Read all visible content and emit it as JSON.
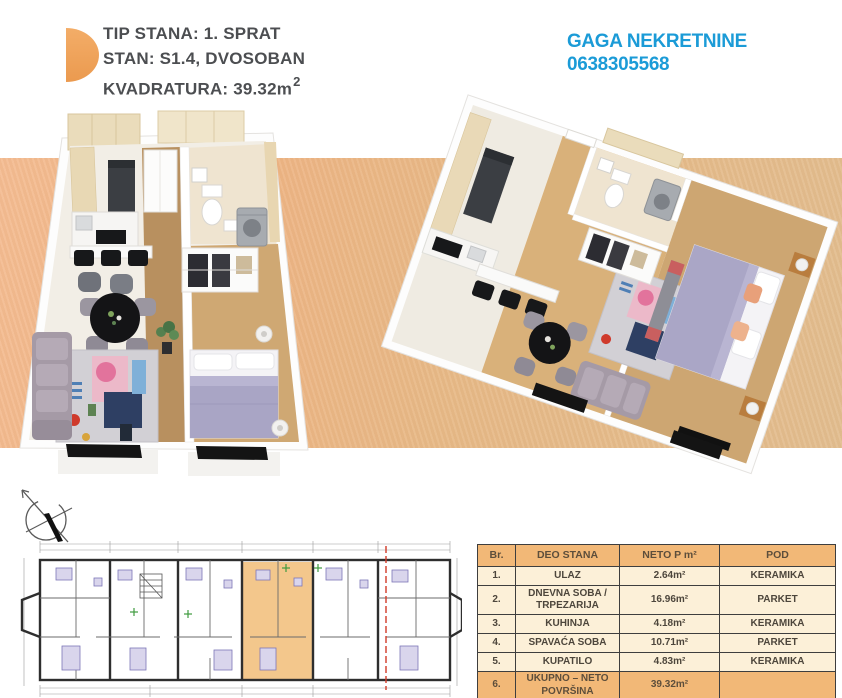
{
  "title_block": {
    "line1": "TIP STANA: 1. SPRAT",
    "line2": "STAN: S1.4, DVOSOBAN",
    "line3_prefix": "KVADRATURA: 39.32m",
    "line3_sup": "2"
  },
  "agency": {
    "name": "GAGA NEKRETNINE",
    "phone": "0638305568",
    "color": "#1b9bd7"
  },
  "table": {
    "headers": [
      "Br.",
      "DEO STANA",
      "NETO P m²",
      "POD"
    ],
    "rows": [
      {
        "br": "1.",
        "deo": "ULAZ",
        "neto": "2.64m²",
        "pod": "KERAMIKA"
      },
      {
        "br": "2.",
        "deo": "DNEVNA SOBA / TRPEZARIJA",
        "neto": "16.96m²",
        "pod": "PARKET"
      },
      {
        "br": "3.",
        "deo": "KUHINJA",
        "neto": "4.18m²",
        "pod": "KERAMIKA"
      },
      {
        "br": "4.",
        "deo": "SPAVAĆA SOBA",
        "neto": "10.71m²",
        "pod": "PARKET"
      },
      {
        "br": "5.",
        "deo": "KUPATILO",
        "neto": "4.83m²",
        "pod": "KERAMIKA"
      },
      {
        "br": "6.",
        "deo": "UKUPNO – NETO POVRŠINA",
        "neto": "39.32m²",
        "pod": ""
      }
    ]
  },
  "colors": {
    "band_left": "#f4bc92",
    "band_right": "#e2bd8f",
    "table_header_bg": "#f2b877",
    "table_body_bg": "#fcf0d8",
    "unit_highlight": "#f3c78c",
    "logo_orange": "#f0a55e",
    "section_line_red": "#d13a28",
    "agency_blue": "#1b9bd7"
  },
  "icons": {
    "logo": "orange-half-disc",
    "compass": "north-arrow-compass"
  }
}
